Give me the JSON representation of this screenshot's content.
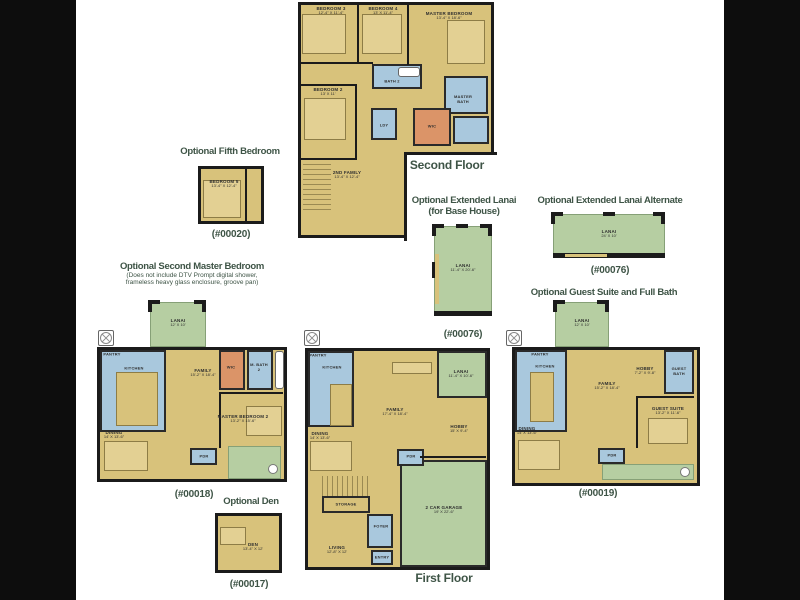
{
  "palette": {
    "floor": "#d8c27b",
    "lanai": "#b6cea2",
    "tile": "#a9c8dd",
    "closet": "#db9468",
    "wall": "#1b1b1b",
    "heading": "#3e5446",
    "paper": "#ffffff",
    "letterbox": "#0d0d0d"
  },
  "second_floor": {
    "title": "Second Floor",
    "bedroom3_name": "BEDROOM 3",
    "bedroom3_dims": "12'-4\" X 11'-4\"",
    "bedroom4_name": "BEDROOM 4",
    "bedroom4_dims": "13' X 11'-4\"",
    "master_name": "MASTER BEDROOM",
    "master_dims": "13'-4\" X 18'-6\"",
    "bath2": "BATH 2",
    "bedroom2_name": "BEDROOM 2",
    "bedroom2_dims": "13' X 11'",
    "master_bath": "MASTER BATH",
    "laundry": "LDY",
    "wic": "WIC",
    "family2_name": "2ND FAMILY",
    "family2_dims": "13'-4\" X 12'-4\""
  },
  "fifth_bedroom": {
    "heading": "Optional Fifth Bedroom",
    "code": "(#00020)",
    "room_name": "BEDROOM 5",
    "room_dims": "13'-4\" X 12'-4\""
  },
  "extended_lanai": {
    "heading_line1": "Optional Extended Lanai",
    "heading_line2": "(for Base House)",
    "code": "(#00076)",
    "room_name": "LANAI",
    "room_dims": "11'-4\" X 20'-6\""
  },
  "extended_lanai_alt": {
    "heading": "Optional Extended Lanai Alternate",
    "code": "(#00076)",
    "room_name": "LANAI",
    "room_dims": "24' X 10'"
  },
  "second_master": {
    "heading": "Optional Second Master Bedroom",
    "note_line1": "(Does not include DTV Prompt digital shower,",
    "note_line2": "frameless heavy glass enclosure, groove pan)",
    "code": "(#00018)",
    "lanai_name": "LANAI",
    "lanai_dims": "12' X 10'",
    "pantry": "PANTRY",
    "kitchen": "KITCHEN",
    "family_name": "FAMILY",
    "family_dims": "15'-2\" X 18'-4\"",
    "wic": "WIC",
    "master_bath2": "M. BATH 2",
    "dining_name": "DINING",
    "dining_dims": "14' X 13'-6\"",
    "master2_name": "MASTER BEDROOM 2",
    "master2_dims": "13'-2\" X 15'-6\"",
    "powder": "PDR"
  },
  "first_floor": {
    "title": "First Floor",
    "pantry": "PANTRY",
    "kitchen": "KITCHEN",
    "family_name": "FAMILY",
    "family_dims": "17'-4\" X 18'-4\"",
    "lanai_name": "LANAI",
    "lanai_dims": "11'-4\" X 10'-6\"",
    "hobby_name": "HOBBY",
    "hobby_dims": "15' X 9'-4\"",
    "dining_name": "DINING",
    "dining_dims": "14' X 13'-6\"",
    "storage": "STORAGE",
    "foyer": "FOYER",
    "powder": "PDR",
    "living_name": "LIVING",
    "living_dims": "12'-8\" X 12'",
    "entry": "ENTRY",
    "garage_name": "2 CAR GARAGE",
    "garage_dims": "19' X 22'-6\""
  },
  "guest_suite": {
    "heading": "Optional Guest Suite and Full Bath",
    "code": "(#00019)",
    "lanai_name": "LANAI",
    "lanai_dims": "12' X 10'",
    "pantry": "PANTRY",
    "kitchen": "KITCHEN",
    "family_name": "FAMILY",
    "family_dims": "15'-2\" X 18'-4\"",
    "hobby_name": "HOBBY",
    "hobby_dims": "7'-2\" X 9'-8\"",
    "guest_bath": "GUEST BATH",
    "dining_name": "DINING",
    "dining_dims": "14' X 13'-6\"",
    "suite_name": "GUEST SUITE",
    "suite_dims": "13'-2\" X 11'-6\"",
    "powder": "PDR"
  },
  "den": {
    "heading": "Optional Den",
    "code": "(#00017)",
    "room_name": "DEN",
    "room_dims": "13'-4\" X 12'"
  }
}
